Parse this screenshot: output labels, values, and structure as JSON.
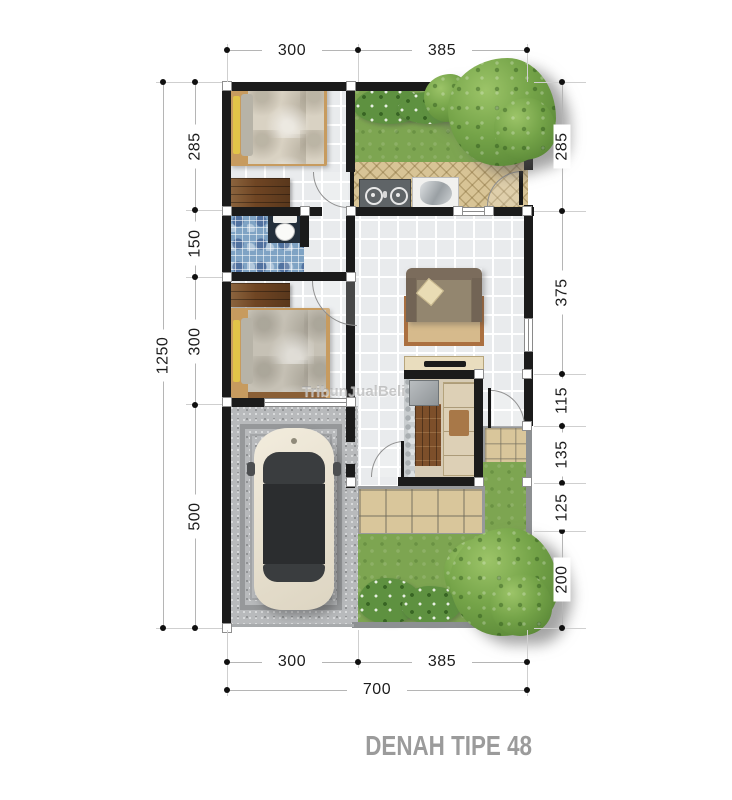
{
  "title": "DENAH TIPE 48",
  "watermark": "TribunJualBeli",
  "dims": {
    "top": [
      "300",
      "385"
    ],
    "bottom": [
      "300",
      "385"
    ],
    "bottom_total": "700",
    "left": [
      "285",
      "150",
      "300",
      "500"
    ],
    "left_total": "1250",
    "right": [
      "285",
      "375",
      "115",
      "135",
      "125",
      "200"
    ]
  },
  "colors": {
    "wall": "#1b1b1b",
    "grass": "#7da551",
    "interior_tile": "#e9ebed",
    "kitchen_tile": "#d8c496",
    "terrace_tile": "#d9c69b",
    "bathroom_tile": "#7fa3c4",
    "gravel": "#b8babc",
    "wood": "#6f4523",
    "car_body": "#ece5d4",
    "title_text": "#9b9b9b"
  }
}
